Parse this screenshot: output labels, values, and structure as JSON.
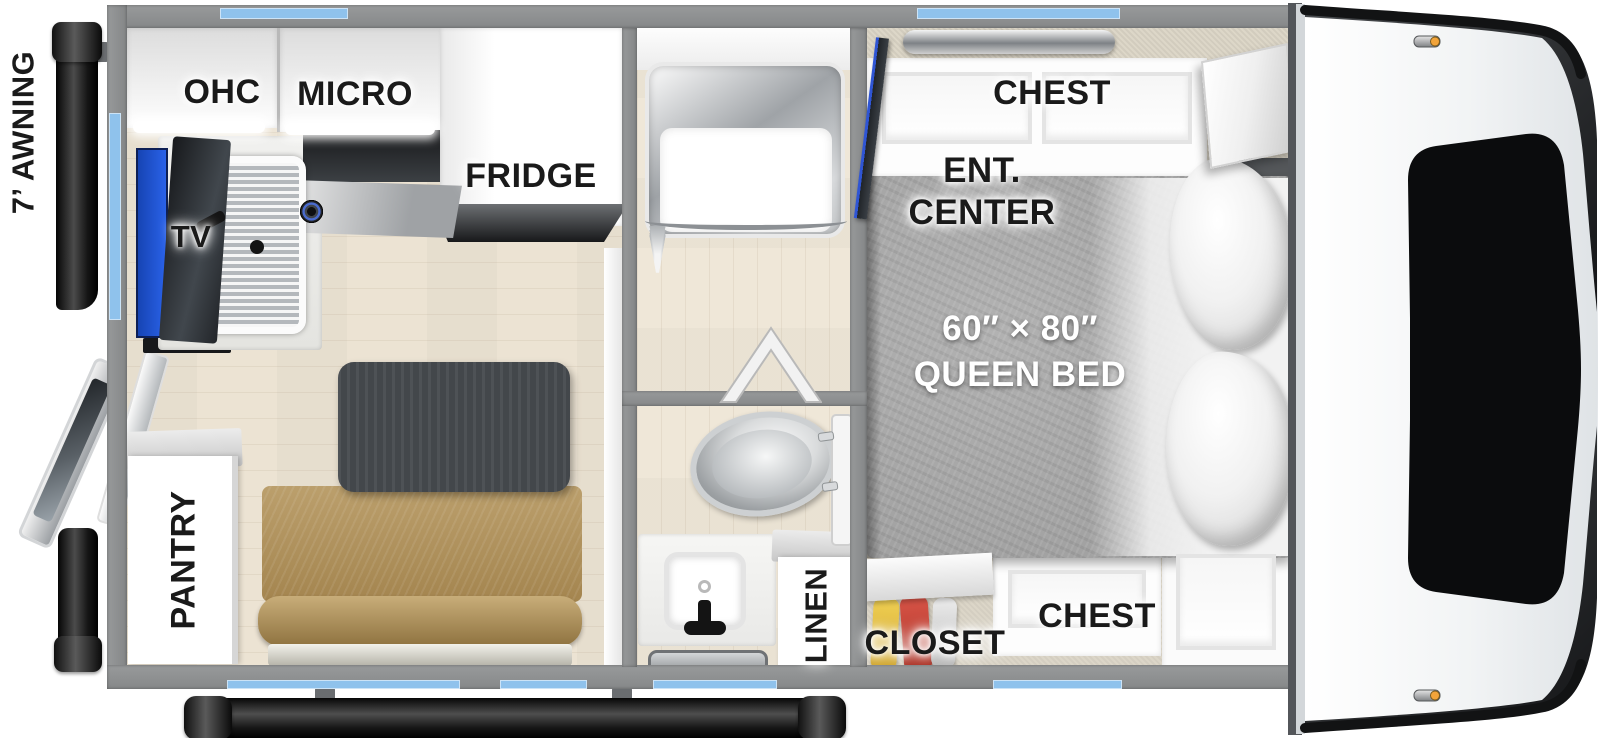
{
  "exterior": {
    "awning_label": "7’ AWNING"
  },
  "kitchen": {
    "ohc_label": "OHC",
    "micro_label": "MICRO",
    "fridge_label": "FRIDGE",
    "tv_label": "TV",
    "pantry_label": "PANTRY"
  },
  "bathroom": {
    "linen_label": "LINEN"
  },
  "bedroom": {
    "chest_top_label": "CHEST",
    "ent_line1": "ENT.",
    "ent_line2": "CENTER",
    "bed_size": "60″ × 80″",
    "bed_type": "QUEEN BED",
    "closet_label": "CLOSET",
    "chest_bottom_label": "CHEST"
  },
  "colors": {
    "window_blue": "#8fc2ec",
    "wall_gray": "#8d8f90",
    "floor_wood": "#ece3d3",
    "bench_tan": "#ad925f",
    "bed_gray": "#a9a9a9",
    "table_dark": "#43474b",
    "tube_black": "#151515"
  }
}
